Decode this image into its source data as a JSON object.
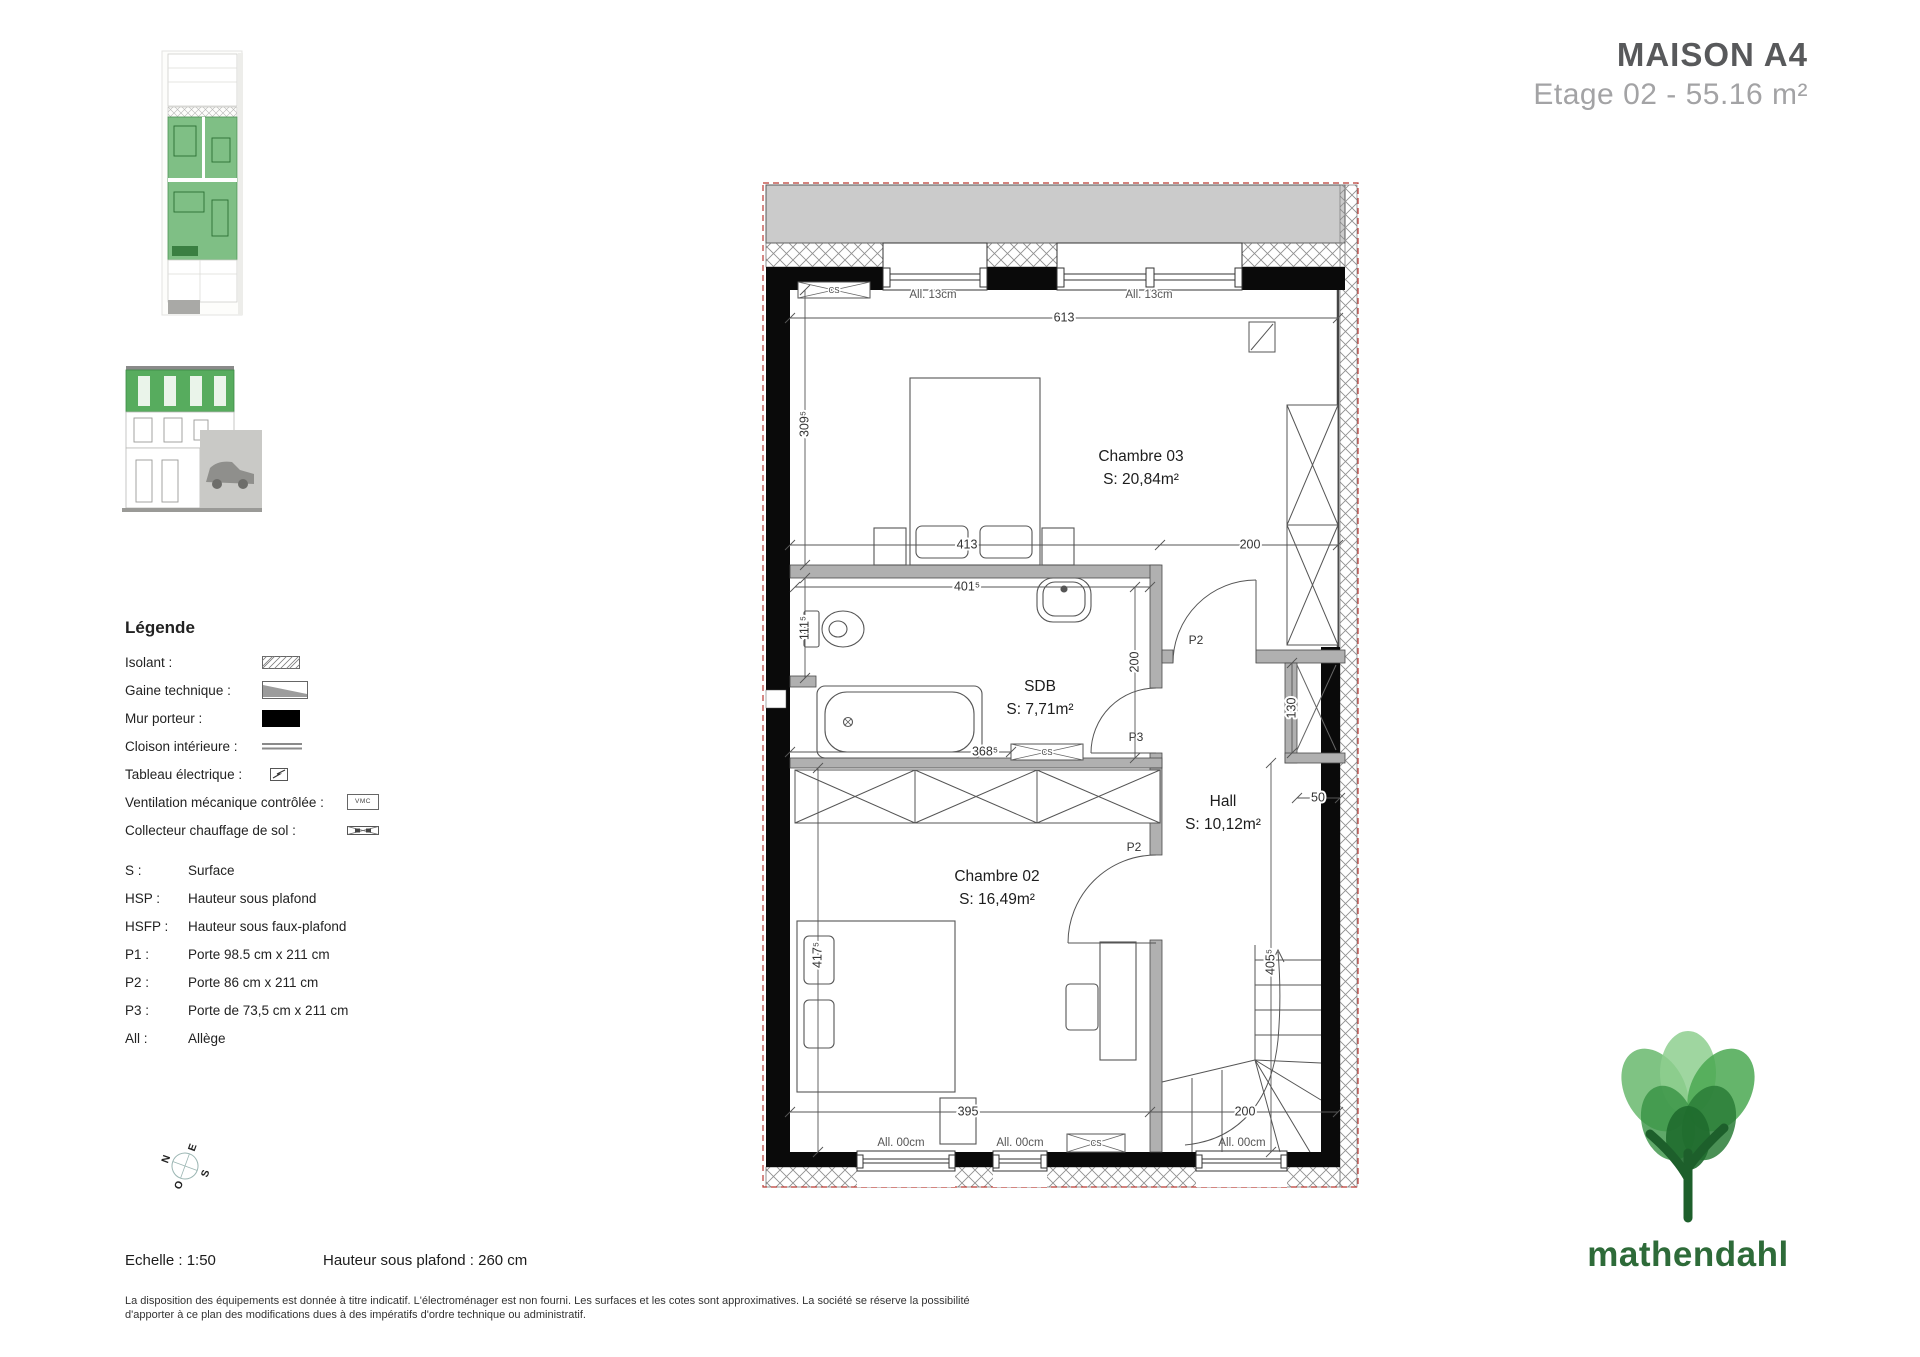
{
  "header": {
    "title": "MAISON A4",
    "subtitle": "Etage 02 - 55.16 m²"
  },
  "legend": {
    "heading": "Légende",
    "items": [
      {
        "label": "Isolant :"
      },
      {
        "label": "Gaine technique :"
      },
      {
        "label": "Mur porteur :"
      },
      {
        "label": "Cloison intérieure :"
      },
      {
        "label": "Tableau électrique :"
      },
      {
        "label": "Ventilation mécanique contrôlée :",
        "symbol_text": "VMC"
      },
      {
        "label": "Collecteur chauffage de sol :"
      }
    ],
    "abbreviations": [
      {
        "abbr": "S :",
        "desc": "Surface"
      },
      {
        "abbr": "HSP :",
        "desc": "Hauteur sous plafond"
      },
      {
        "abbr": "HSFP :",
        "desc": "Hauteur sous faux-plafond"
      },
      {
        "abbr": "P1 :",
        "desc": "Porte 98.5 cm x 211 cm"
      },
      {
        "abbr": "P2 :",
        "desc": "Porte 86 cm x 211 cm"
      },
      {
        "abbr": "P3 :",
        "desc": "Porte de 73,5 cm x 211 cm"
      },
      {
        "abbr": "All :",
        "desc": "Allège"
      }
    ]
  },
  "plan": {
    "rooms": {
      "chambre03": {
        "name": "Chambre 03",
        "area": "S: 20,84m²"
      },
      "sdb": {
        "name": "SDB",
        "area": "S: 7,71m²"
      },
      "hall": {
        "name": "Hall",
        "area": "S: 10,12m²"
      },
      "chambre02": {
        "name": "Chambre 02",
        "area": "S: 16,49m²"
      }
    },
    "dims": {
      "d613": "613",
      "d309": "309⁵",
      "d413": "413",
      "d200_top": "200",
      "d401": "401⁵",
      "d111": "111⁵",
      "d200_sdb": "200",
      "d368": "368⁵",
      "d130": "130",
      "d50": "50",
      "d417": "417⁵",
      "d405": "405⁵",
      "d395": "395",
      "d200_bottom": "200"
    },
    "doors": {
      "p2_hall": "P2",
      "p3_sdb": "P3",
      "p2_ch02": "P2"
    },
    "alleges": {
      "top1": "All. 13cm",
      "top2": "All. 13cm",
      "bot1": "All. 00cm",
      "bot2": "All. 00cm",
      "bot3": "All. 00cm"
    },
    "cs_label": "CS"
  },
  "compass": {
    "n": "N",
    "e": "E",
    "s": "S",
    "o": "O"
  },
  "footer": {
    "scale": "Echelle : 1:50",
    "ceiling": "Hauteur sous plafond : 260 cm",
    "disclaimer_line1": "La disposition des équipements est donnée à titre indicatif. L'électroménager est non fourni. Les surfaces et les cotes sont approximatives. La société se réserve la possibilité",
    "disclaimer_line2": "d'apporter à ce plan des modifications dues à des impératifs d'ordre technique ou administratif."
  },
  "logo": {
    "brand": "mathendahl"
  },
  "colors": {
    "wall": "#0a0a0a",
    "partition": "#b0b0b0",
    "terrace": "#cbcbcb",
    "boundary_red": "#bb3a33",
    "green": "#4ca352",
    "logo_green": "#2e6b39",
    "title_gray": "#58595b",
    "subtitle_gray": "#a3a3a5"
  }
}
